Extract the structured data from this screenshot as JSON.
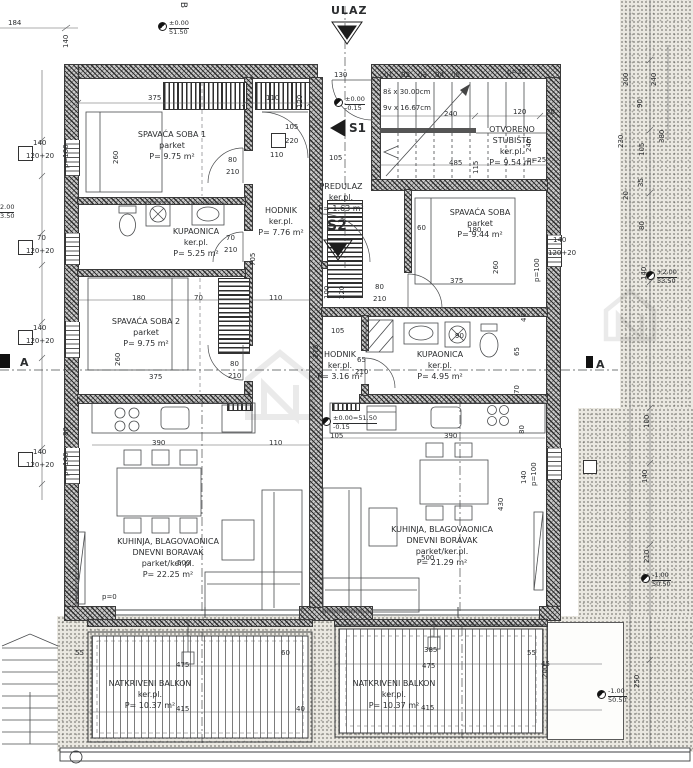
{
  "markers": {
    "ulaz": "ULAZ",
    "s1": "S1",
    "s2": "S2",
    "section": "A",
    "grid": "B"
  },
  "stairs": {
    "run": "8š x 30.00cm",
    "rise": "9v x 16.67cm",
    "treads": [
      {
        "n": "01",
        "x": 384
      },
      {
        "n": "02",
        "x": 401
      },
      {
        "n": "03",
        "x": 418
      },
      {
        "n": "04",
        "x": 435
      },
      {
        "n": "05",
        "x": 451
      }
    ]
  },
  "rooms": [
    {
      "lines": [
        "SPAVAĆA SOBA 1",
        "parket",
        "P= 9.75 m²"
      ],
      "cx": 172,
      "y": 129
    },
    {
      "lines": [
        "KUPAONICA",
        "ker.pl.",
        "P= 5.25 m²"
      ],
      "cx": 196,
      "y": 226
    },
    {
      "lines": [
        "SPAVAĆA SOBA 2",
        "parket",
        "P= 9.75 m²"
      ],
      "cx": 146,
      "y": 316
    },
    {
      "lines": [
        "HODNIK",
        "ker.pl.",
        "P= 7.76 m²"
      ],
      "cx": 281,
      "y": 205
    },
    {
      "lines": [
        "KUHINJA, BLAGOVAONICA",
        "DNEVNI BORAVAK",
        "parket/ker.pl.",
        "P= 22.25 m²"
      ],
      "cx": 168,
      "y": 536
    },
    {
      "lines": [
        "NATKRIVENI BALKON",
        "ker.pl.",
        "P= 10.37 m²"
      ],
      "cx": 150,
      "y": 678
    },
    {
      "lines": [
        "PREDULAZ",
        "ker.pl.",
        "P= 1.63 m²"
      ],
      "cx": 341,
      "y": 181
    },
    {
      "lines": [
        "SPAVAĆA SOBA",
        "parket",
        "P= 9.44 m²"
      ],
      "cx": 480,
      "y": 207
    },
    {
      "lines": [
        "HODNIK",
        "ker.pl.",
        "P= 3.16 m²"
      ],
      "cx": 340,
      "y": 349
    },
    {
      "lines": [
        "KUPAONICA",
        "ker.pl.",
        "P= 4.95 m²"
      ],
      "cx": 440,
      "y": 349
    },
    {
      "lines": [
        "KUHINJA, BLAGOVAONICA",
        "DNEVNI BORAVAK",
        "parket/ker.pl.",
        "P= 21.29 m²"
      ],
      "cx": 442,
      "y": 524
    },
    {
      "lines": [
        "NATKRIVENI BALKON",
        "ker.pl.",
        "P= 10.37 m²"
      ],
      "cx": 394,
      "y": 678
    },
    {
      "lines": [
        "OTVORENO",
        "STUBIŠTE",
        "ker.pl.",
        "P= 9.54 m²"
      ],
      "cx": 512,
      "y": 124
    }
  ],
  "levels": [
    {
      "a": "±0.00",
      "b": "51.50",
      "x": 158,
      "y": 20
    },
    {
      "a": "±0.00",
      "b": "-0.15",
      "x": 334,
      "y": 96
    },
    {
      "a": "±0.00=51.50",
      "b": "-0.15",
      "x": 322,
      "y": 415
    },
    {
      "a": "+2.00",
      "b": "53.50",
      "x": 646,
      "y": 269
    },
    {
      "a": "-1.00",
      "b": "50.50",
      "x": 641,
      "y": 572
    },
    {
      "a": "-1.00",
      "b": "50.50",
      "x": 597,
      "y": 688
    },
    {
      "a": "2.00",
      "b": "3.50",
      "x": 0,
      "y": 204,
      "noglyph": true
    }
  ],
  "dimensions": [
    {
      "t": "184",
      "x": 8,
      "y": 19
    },
    {
      "t": "140",
      "x": 70,
      "y": 40,
      "v": true
    },
    {
      "t": "130",
      "x": 334,
      "y": 71
    },
    {
      "t": "120",
      "x": 304,
      "y": 100,
      "v": true
    },
    {
      "t": "p=25",
      "x": 507,
      "y": 68
    },
    {
      "t": "120",
      "x": 513,
      "y": 108
    },
    {
      "t": "20",
      "x": 546,
      "y": 108
    },
    {
      "t": "240",
      "x": 444,
      "y": 110
    },
    {
      "t": "240",
      "x": 533,
      "y": 144,
      "v": true
    },
    {
      "t": "485",
      "x": 449,
      "y": 159
    },
    {
      "t": "115",
      "x": 480,
      "y": 166,
      "v": true
    },
    {
      "t": "p=25",
      "x": 527,
      "y": 156
    },
    {
      "t": "375",
      "x": 148,
      "y": 94
    },
    {
      "t": "110",
      "x": 266,
      "y": 94
    },
    {
      "t": "105",
      "x": 285,
      "y": 123
    },
    {
      "t": "220",
      "x": 285,
      "y": 137
    },
    {
      "t": "110",
      "x": 270,
      "y": 151
    },
    {
      "t": "80",
      "x": 228,
      "y": 156
    },
    {
      "t": "210",
      "x": 226,
      "y": 168
    },
    {
      "t": "140",
      "x": 33,
      "y": 139
    },
    {
      "t": "120+20",
      "x": 26,
      "y": 152
    },
    {
      "t": "70",
      "x": 37,
      "y": 234
    },
    {
      "t": "120+20",
      "x": 26,
      "y": 247
    },
    {
      "t": "140",
      "x": 33,
      "y": 324
    },
    {
      "t": "120+20",
      "x": 26,
      "y": 337
    },
    {
      "t": "140",
      "x": 33,
      "y": 448
    },
    {
      "t": "120+20",
      "x": 26,
      "y": 461
    },
    {
      "t": "70",
      "x": 226,
      "y": 234
    },
    {
      "t": "210",
      "x": 224,
      "y": 246
    },
    {
      "t": "705",
      "x": 257,
      "y": 258,
      "v": true
    },
    {
      "t": "p=100",
      "x": 70,
      "y": 160,
      "v": true
    },
    {
      "t": "260",
      "x": 120,
      "y": 156,
      "v": true
    },
    {
      "t": "180",
      "x": 132,
      "y": 294
    },
    {
      "t": "70",
      "x": 194,
      "y": 294
    },
    {
      "t": "110",
      "x": 269,
      "y": 294
    },
    {
      "t": "260",
      "x": 122,
      "y": 358,
      "v": true
    },
    {
      "t": "375",
      "x": 149,
      "y": 373
    },
    {
      "t": "80",
      "x": 230,
      "y": 360
    },
    {
      "t": "210",
      "x": 228,
      "y": 372
    },
    {
      "t": "80",
      "x": 70,
      "y": 428,
      "v": true
    },
    {
      "t": "390",
      "x": 152,
      "y": 439
    },
    {
      "t": "110",
      "x": 269,
      "y": 439
    },
    {
      "t": "500",
      "x": 177,
      "y": 559
    },
    {
      "t": "p=0",
      "x": 102,
      "y": 593
    },
    {
      "t": "p=100",
      "x": 70,
      "y": 468,
      "v": true
    },
    {
      "t": "105",
      "x": 329,
      "y": 154
    },
    {
      "t": "100",
      "x": 331,
      "y": 291,
      "v": true
    },
    {
      "t": "220",
      "x": 346,
      "y": 291,
      "v": true
    },
    {
      "t": "105",
      "x": 331,
      "y": 327
    },
    {
      "t": "275",
      "x": 320,
      "y": 350,
      "v": true
    },
    {
      "t": "80",
      "x": 375,
      "y": 283
    },
    {
      "t": "210",
      "x": 373,
      "y": 295
    },
    {
      "t": "60",
      "x": 417,
      "y": 224
    },
    {
      "t": "180",
      "x": 468,
      "y": 226
    },
    {
      "t": "375",
      "x": 450,
      "y": 277
    },
    {
      "t": "260",
      "x": 500,
      "y": 266,
      "v": true
    },
    {
      "t": "40",
      "x": 528,
      "y": 314,
      "v": true
    },
    {
      "t": "p=100",
      "x": 541,
      "y": 274,
      "v": true
    },
    {
      "t": "140",
      "x": 553,
      "y": 236
    },
    {
      "t": "120+20",
      "x": 548,
      "y": 249
    },
    {
      "t": "90",
      "x": 455,
      "y": 332
    },
    {
      "t": "65",
      "x": 521,
      "y": 348,
      "v": true
    },
    {
      "t": "70",
      "x": 521,
      "y": 386,
      "v": true
    },
    {
      "t": "65",
      "x": 357,
      "y": 356
    },
    {
      "t": "210",
      "x": 355,
      "y": 368
    },
    {
      "t": "80",
      "x": 526,
      "y": 426,
      "v": true
    },
    {
      "t": "105",
      "x": 330,
      "y": 432
    },
    {
      "t": "390",
      "x": 444,
      "y": 432
    },
    {
      "t": "430",
      "x": 505,
      "y": 503,
      "v": true
    },
    {
      "t": "140",
      "x": 528,
      "y": 476,
      "v": true
    },
    {
      "t": "p=100",
      "x": 538,
      "y": 478,
      "v": true
    },
    {
      "t": "500",
      "x": 421,
      "y": 554
    },
    {
      "t": "55",
      "x": 75,
      "y": 649
    },
    {
      "t": "475",
      "x": 176,
      "y": 661
    },
    {
      "t": "60",
      "x": 281,
      "y": 649
    },
    {
      "t": "415",
      "x": 176,
      "y": 705
    },
    {
      "t": "40",
      "x": 296,
      "y": 705
    },
    {
      "t": "385",
      "x": 424,
      "y": 646
    },
    {
      "t": "475",
      "x": 422,
      "y": 662
    },
    {
      "t": "415",
      "x": 421,
      "y": 704
    },
    {
      "t": "55",
      "x": 527,
      "y": 649
    },
    {
      "t": "45",
      "x": 541,
      "y": 660
    },
    {
      "t": "200",
      "x": 549,
      "y": 670,
      "v": true
    },
    {
      "t": "250",
      "x": 641,
      "y": 680,
      "v": true
    },
    {
      "t": "230",
      "x": 625,
      "y": 140,
      "v": true
    },
    {
      "t": "200",
      "x": 630,
      "y": 78,
      "v": true
    },
    {
      "t": "240",
      "x": 658,
      "y": 78,
      "v": true
    },
    {
      "t": "90",
      "x": 644,
      "y": 100,
      "v": true
    },
    {
      "t": "380",
      "x": 666,
      "y": 135,
      "v": true
    },
    {
      "t": "105",
      "x": 646,
      "y": 148,
      "v": true
    },
    {
      "t": "35",
      "x": 645,
      "y": 179,
      "v": true
    },
    {
      "t": "20",
      "x": 630,
      "y": 192,
      "v": true
    },
    {
      "t": "80",
      "x": 646,
      "y": 222,
      "v": true
    },
    {
      "t": "140",
      "x": 648,
      "y": 272,
      "v": true
    },
    {
      "t": "100",
      "x": 651,
      "y": 420,
      "v": true
    },
    {
      "t": "140",
      "x": 649,
      "y": 475,
      "v": true
    },
    {
      "t": "210",
      "x": 651,
      "y": 555,
      "v": true
    }
  ]
}
